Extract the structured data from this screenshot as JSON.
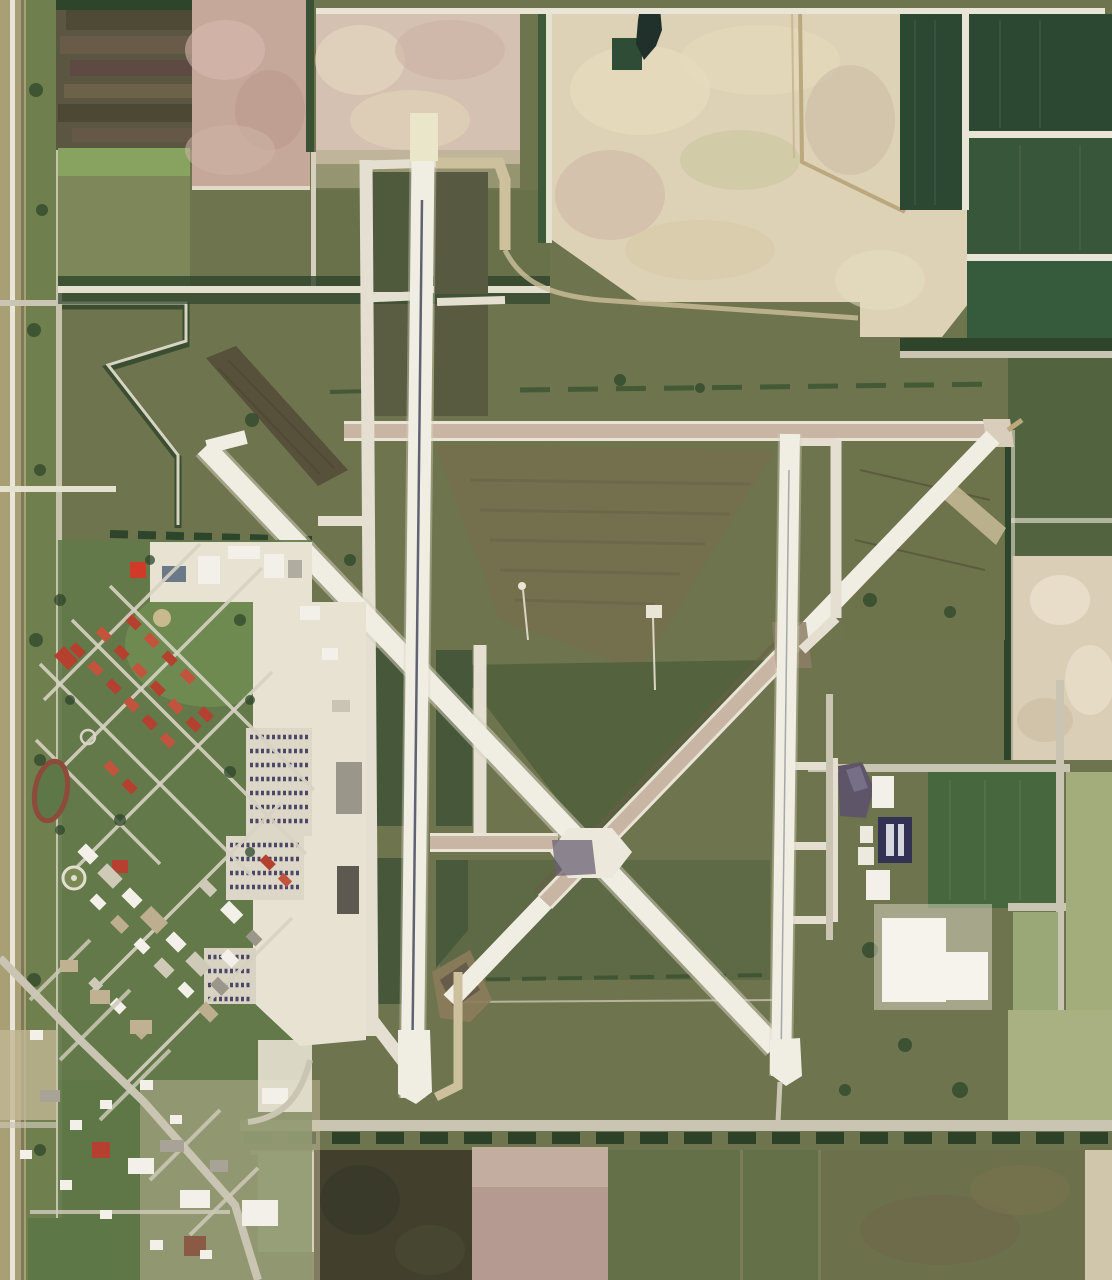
{
  "meta": {
    "title": "Satellite aerial photograph of an airfield with triangular runway layout, west-side campus town and surrounding farm fields",
    "width_px": 1112,
    "height_px": 1280
  },
  "features": {
    "main_runway": "Main north-south runway with dark centerline",
    "parallel_taxiway_west": "Parallel taxiway west of main runway",
    "diagonal_runway_nw_se": "Diagonal runway NW to SE",
    "diagonal_runway_ne_sw": "Diagonal runway NE to SW (old pink pavement mid-section)",
    "east_runway": "Eastern north-south runway",
    "crossfield_taxiway": "East-west pink taxiway across airfield",
    "terminal_apron": "Terminal apron with hangars",
    "aircraft_rows": "Rows of parked aircraft on apron",
    "campus": "Base housing campus with red-roofed buildings",
    "running_track": "Oval running track",
    "helipad": "Circular helipad",
    "east_hangars": "Hangar group near east runway",
    "warehouse": "Large white warehouse building",
    "pond": "Small dark pond",
    "farm_fields": "Patchwork of crop and bare-soil fields",
    "town": "Small town street grid at lower left"
  },
  "palette": {
    "base_olive": "#6d744e",
    "grass_light": "#7d8759",
    "grass_dark": "#565e3e",
    "island_dark": "#4f5a3d",
    "hedge": "#2e452b",
    "runway_white": "#f0ede3",
    "taxiway_white": "#e4dfd1",
    "taxiway_tan": "#cdc09c",
    "taxiway_pink": "#c8b5a3",
    "pad_cream": "#e9e6ca",
    "centerline": "#3a4057",
    "beige": "#ddd2b6",
    "cloud_pink": "#d4c1b1",
    "pink_field": "#c6a89b",
    "crop_dark": "#2c4833",
    "crop_mid": "#37563a",
    "pale_green": "#a3ad7c",
    "pale_tan": "#cfc6ab",
    "mauve": "#b49a91",
    "dark_field": "#42402d",
    "brown_band": "#57503a",
    "brown_patch": "#75704e",
    "apron": "#e7e2d2",
    "bldg_white": "#f2f0e8",
    "bldg_gray": "#9b968a",
    "red_roof": "#b5402f",
    "red_bright": "#d03a27",
    "purple_hangar": "#5e5569",
    "navy_hangar": "#343253",
    "track_red": "#8e4a3a",
    "pond": "#1f312a",
    "road": "#cac5b3",
    "warehouse": "#f5f3ec"
  }
}
